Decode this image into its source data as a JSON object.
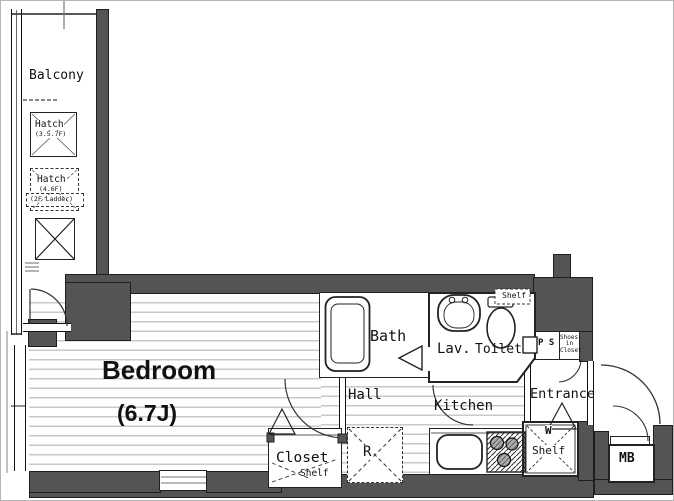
{
  "title": "Studio apartment floor plan",
  "colors": {
    "wall": "#545454",
    "wall_outline": "#1e1e1e",
    "floor_line": "#c9c9c9",
    "line": "#222222",
    "background": "#ffffff"
  },
  "rooms": {
    "balcony": {
      "label": "Balcony"
    },
    "bedroom": {
      "label": "Bedroom",
      "size": "(6.7J)"
    },
    "bath": {
      "label": "Bath"
    },
    "lavatory": {
      "label": "Lav."
    },
    "toilet": {
      "label": "Toilet",
      "shelf": "Shelf"
    },
    "hall": {
      "label": "Hall"
    },
    "kitchen": {
      "label": "Kitchen"
    },
    "entrance": {
      "label": "Entrance"
    }
  },
  "features": {
    "hatch_upper": {
      "label": "Hatch",
      "floors": "(3.5.7F)"
    },
    "hatch_lower": {
      "label": "Hatch",
      "floors": "(4.6F)",
      "note": "(2F Ladder)"
    },
    "pipe_space": {
      "label": "P S"
    },
    "shoes_closet": {
      "line1": "Shoes-in",
      "line2": "Closet"
    },
    "closet": {
      "label": "Closet",
      "shelf": "Shelf"
    },
    "refrigerator": {
      "label": "R"
    },
    "washer": {
      "label": "W",
      "shelf": "Shelf"
    },
    "meter_box": {
      "label": "MB"
    }
  }
}
